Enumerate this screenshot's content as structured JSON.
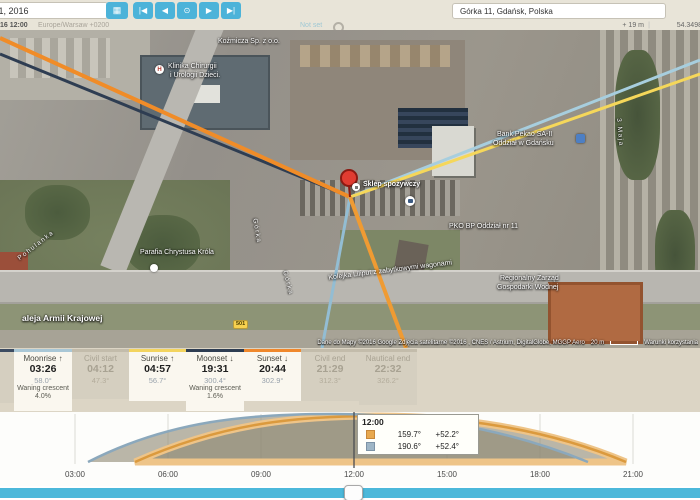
{
  "toolbar": {
    "date_value": "August 1, 2016",
    "calendar_icon": "calendar-icon",
    "nav": {
      "first": "|◀",
      "prev": "◀",
      "now": "⊙",
      "next": "▶",
      "last": "▶|"
    }
  },
  "subbar": {
    "datetime": "16 12:00",
    "timezone": "Europe/Warsaw +0200",
    "not_set": "Not set",
    "elevation": "+ 19 m",
    "separator": "|",
    "latitude": "54.3498"
  },
  "search": {
    "value": "Górka 11, Gdańsk, Polska"
  },
  "map": {
    "labels": [
      {
        "text": "Koźmicza Sp. z o.o."
      },
      {
        "text": "Klinika Chirurgii"
      },
      {
        "text": "i Urologii Dzieci."
      },
      {
        "text": "Bank Pekao SA-II"
      },
      {
        "text": "Oddział w Gdańsku"
      },
      {
        "text": "Sklep spożywczy"
      },
      {
        "text": "PKO BP Oddział nr 11"
      },
      {
        "text": "Parafia Chrystusa Króla"
      },
      {
        "text": "Regionalny Zarząd"
      },
      {
        "text": "Gospodarki Wodnej"
      },
      {
        "text": "Kolejka Liliput z zabytkowymi wagonami"
      },
      {
        "text": "aleja Armii Krajowej"
      },
      {
        "text": "Pohulanka"
      },
      {
        "text": "Górka"
      },
      {
        "text": "Górka"
      },
      {
        "text": "3 Maja"
      }
    ],
    "hospital_icon_letter": "H",
    "road_badge": "501",
    "attribution": "Dane do Mapy ©2016 Google Zdjęcia satelitarne ©2016 , CNES / Astrium, DigitalGlobe, MGGP Aero",
    "scale_label": "20 m",
    "terms": "Warunki korzystania"
  },
  "panel": {
    "cells": [
      {
        "label": "",
        "time": "",
        "azimuth": ""
      },
      {
        "label": "Moonrise ↑",
        "time": "03:26",
        "azimuth": "58.0°",
        "phase": "Waning crescent",
        "phase_pct": "4.0%",
        "accent": "#a9c7d6"
      },
      {
        "label": "Civil start",
        "time": "04:12",
        "azimuth": "47.3°"
      },
      {
        "label": "Sunrise ↑",
        "time": "04:57",
        "azimuth": "56.7°",
        "accent": "#f3d45e"
      },
      {
        "label": "Moonset ↓",
        "time": "19:31",
        "azimuth": "300.4°",
        "phase": "Waning crescent",
        "phase_pct": "1.6%",
        "accent": "#2e3d52"
      },
      {
        "label": "Sunset ↓",
        "time": "20:44",
        "azimuth": "302.9°",
        "accent": "#f0882c"
      },
      {
        "label": "Civil end",
        "time": "21:29",
        "azimuth": "312.3°"
      },
      {
        "label": "Nautical end",
        "time": "22:32",
        "azimuth": "326.2°"
      }
    ]
  },
  "chart": {
    "times": [
      "03:00",
      "06:00",
      "09:00",
      "12:00",
      "15:00",
      "18:00",
      "21:00"
    ],
    "tooltip": {
      "time": "12:00",
      "sun": {
        "azimuth": "159.7°",
        "altitude": "+52.2°",
        "color": "#e8a94f"
      },
      "moon": {
        "azimuth": "190.6°",
        "altitude": "+52.4°",
        "color": "#9fb6c6"
      }
    }
  },
  "chart_data": {
    "type": "area",
    "title": "Sun and moon altitude over the day",
    "x": [
      0,
      3,
      6,
      9,
      12,
      15,
      18,
      21,
      24
    ],
    "xlabel": "time of day",
    "ylabel": "altitude (°)",
    "series": [
      {
        "name": "sun_altitude_deg",
        "values": [
          -14,
          -9,
          10,
          35,
          52.2,
          44,
          22,
          -2,
          -16
        ],
        "events": {
          "sunrise": "04:57",
          "sunset": "20:44",
          "noon_azimuth": 159.7,
          "noon_altitude": 52.2
        }
      },
      {
        "name": "moon_altitude_deg",
        "values": [
          -8,
          -4,
          18,
          40,
          52.4,
          35,
          12,
          -12,
          -20
        ],
        "events": {
          "moonrise": "03:26",
          "moonset": "19:31",
          "noon_azimuth": 190.6,
          "noon_altitude": 52.4
        }
      }
    ],
    "cursor_x": "12:00",
    "grid": true,
    "legend_position": "tooltip"
  }
}
